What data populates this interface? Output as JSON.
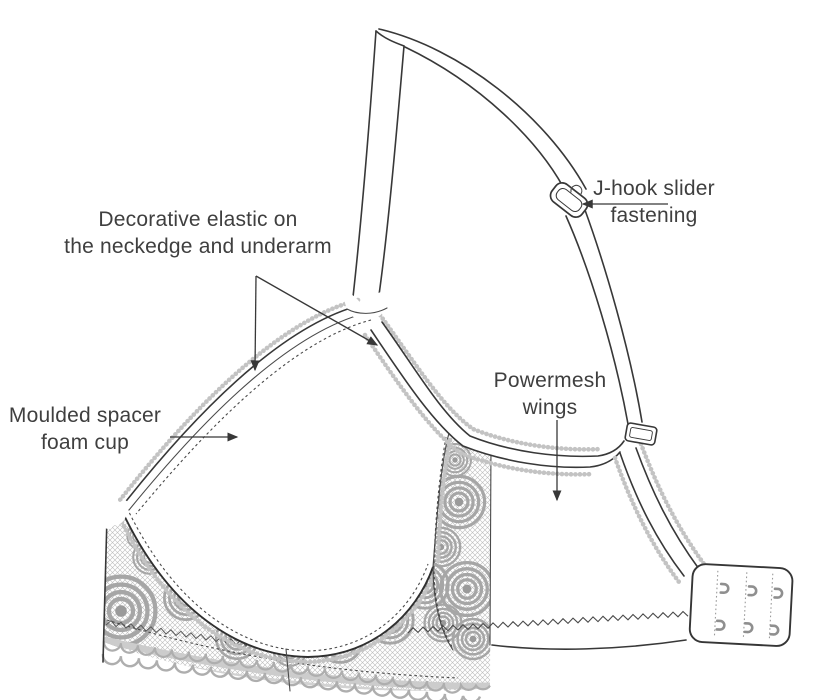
{
  "diagram": {
    "subject": "bra-construction-illustration",
    "labels": {
      "decorative_elastic": {
        "line1": "Decorative elastic on",
        "line2": "the neckedge and underarm"
      },
      "j_hook": {
        "line1": "J-hook slider",
        "line2": "fastening"
      },
      "moulded_cup": {
        "line1": "Moulded spacer",
        "line2": "foam cup"
      },
      "powermesh": {
        "line1": "Powermesh",
        "line2": "wings"
      }
    },
    "colors": {
      "line_art": "#383838",
      "lace_gray": "#a6a6a6",
      "label_text": "#3f3f3f",
      "background": "#ffffff"
    }
  }
}
